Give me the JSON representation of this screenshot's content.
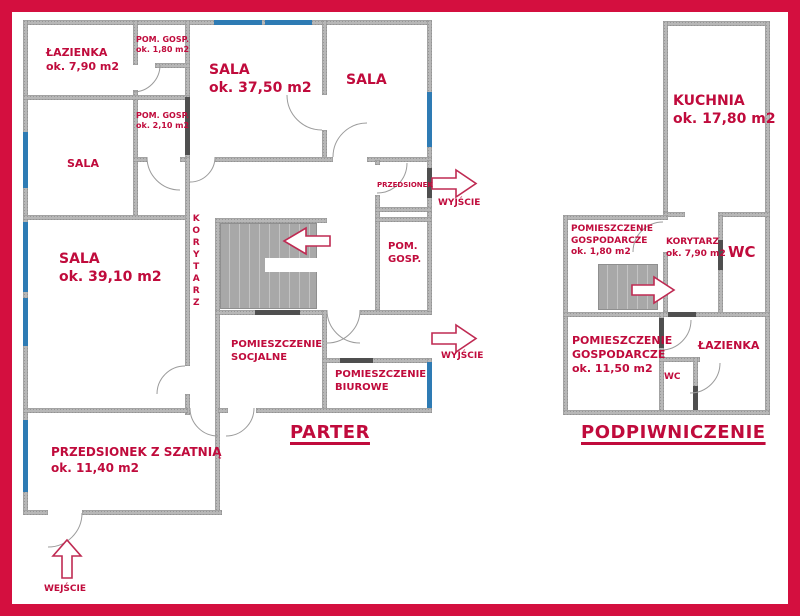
{
  "colors": {
    "frame": "#d40f3f",
    "label_text": "#c00b3c",
    "wall": "#b7b7b7",
    "door_jamb": "#4f4f4f",
    "window": "#2e7bb4",
    "stairs": "#a8a8a8",
    "arrow_outline": "#bf2a52"
  },
  "parter": {
    "title": "PARTER",
    "rooms": {
      "lazienka": {
        "line1": "ŁAZIENKA",
        "line2": "ok. 7,90 m2"
      },
      "pom_gosp_180": {
        "line1": "POM. GOSP.",
        "line2": "ok. 1,80 m2"
      },
      "sala_3750": {
        "line1": "SALA",
        "line2": "ok. 37,50 m2"
      },
      "sala_top_right": {
        "line1": "SALA"
      },
      "pom_gosp_210": {
        "line1": "POM. GOSP.",
        "line2": "ok. 2,10 m2"
      },
      "sala_mid": {
        "line1": "SALA"
      },
      "sala_3910": {
        "line1": "SALA",
        "line2": "ok. 39,10 m2"
      },
      "korytarz": {
        "line1": "KORYTARZ"
      },
      "przedsionek": {
        "line1": "PRZEDSIONEK"
      },
      "pom_gosp": {
        "line1": "POM.",
        "line2": "GOSP."
      },
      "socjalne": {
        "line1": "POMIESZCZENIE",
        "line2": "SOCJALNE"
      },
      "biurowe": {
        "line1": "POMIESZCZENIE",
        "line2": "BIUROWE"
      },
      "przedsionek_szatnia": {
        "line1": "PRZEDSIONEK Z SZATNIĄ",
        "line2": "ok. 11,40 m2"
      }
    },
    "annotations": {
      "wyjscie_top": "WYJŚCIE",
      "wyjscie_bottom": "WYJŚCIE",
      "wejscie": "WEJŚCIE"
    }
  },
  "podpiwniczenie": {
    "title": "PODPIWNICZENIE",
    "rooms": {
      "kuchnia": {
        "line1": "KUCHNIA",
        "line2": "ok. 17,80 m2"
      },
      "pom_gosp_180": {
        "line1": "POMIESZCZENIE",
        "line2": "GOSPODARCZE",
        "line3": "ok. 1,80 m2"
      },
      "korytarz": {
        "line1": "KORYTARZ",
        "line2": "ok. 7,90 m2"
      },
      "wc_top": {
        "line1": "WC"
      },
      "pom_gosp_1150": {
        "line1": "POMIESZCZENIE",
        "line2": "GOSPODARCZE",
        "line3": "ok. 11,50 m2"
      },
      "lazienka": {
        "line1": "ŁAZIENKA"
      },
      "wc_bottom": {
        "line1": "WC"
      }
    }
  }
}
